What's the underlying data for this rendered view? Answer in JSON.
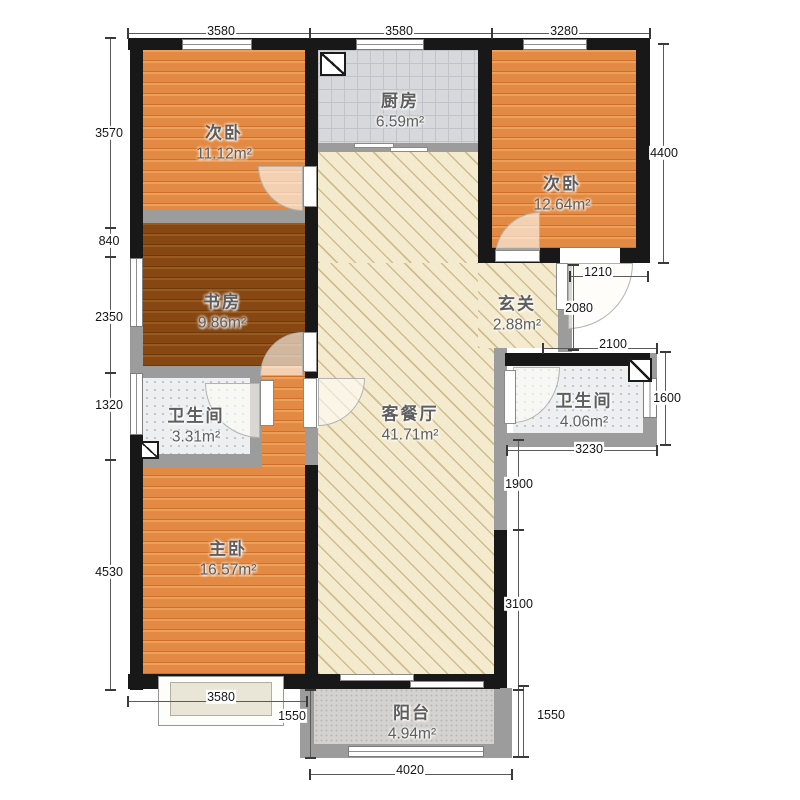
{
  "plan": {
    "rooms": [
      {
        "name": "次卧",
        "area": "11.12m²"
      },
      {
        "name": "厨房",
        "area": "6.59m²"
      },
      {
        "name": "次卧",
        "area": "12.64m²"
      },
      {
        "name": "书房",
        "area": "9.86m²"
      },
      {
        "name": "玄关",
        "area": "2.88m²"
      },
      {
        "name": "卫生间",
        "area": "3.31m²"
      },
      {
        "name": "客餐厅",
        "area": "41.71m²"
      },
      {
        "name": "卫生间",
        "area": "4.06m²"
      },
      {
        "name": "主卧",
        "area": "16.57m²"
      },
      {
        "name": "阳台",
        "area": "4.94m²"
      }
    ],
    "dimensions": {
      "top": [
        "3580",
        "3580",
        "3280"
      ],
      "left": [
        "3570",
        "840",
        "2350",
        "1320",
        "4530"
      ],
      "right_outer": [
        "4400",
        "1600"
      ],
      "right_inner": [
        "1900",
        "3100"
      ],
      "entry": [
        "1210",
        "2080",
        "2100",
        "3230"
      ],
      "bottom": [
        "3580",
        "1550",
        "4020",
        "1550"
      ]
    },
    "colors": {
      "wall": "#181818",
      "partition_wall": "#9c9c9c",
      "bedroom_floor": "#e28a43",
      "study_floor": "#864712",
      "living_floor": "#f4ebcf",
      "kitchen_tile": "#d7d8db",
      "bath_tile": "#edeff1",
      "balcony_tile": "#d3d2d0",
      "dimension_text": "#151515"
    }
  }
}
